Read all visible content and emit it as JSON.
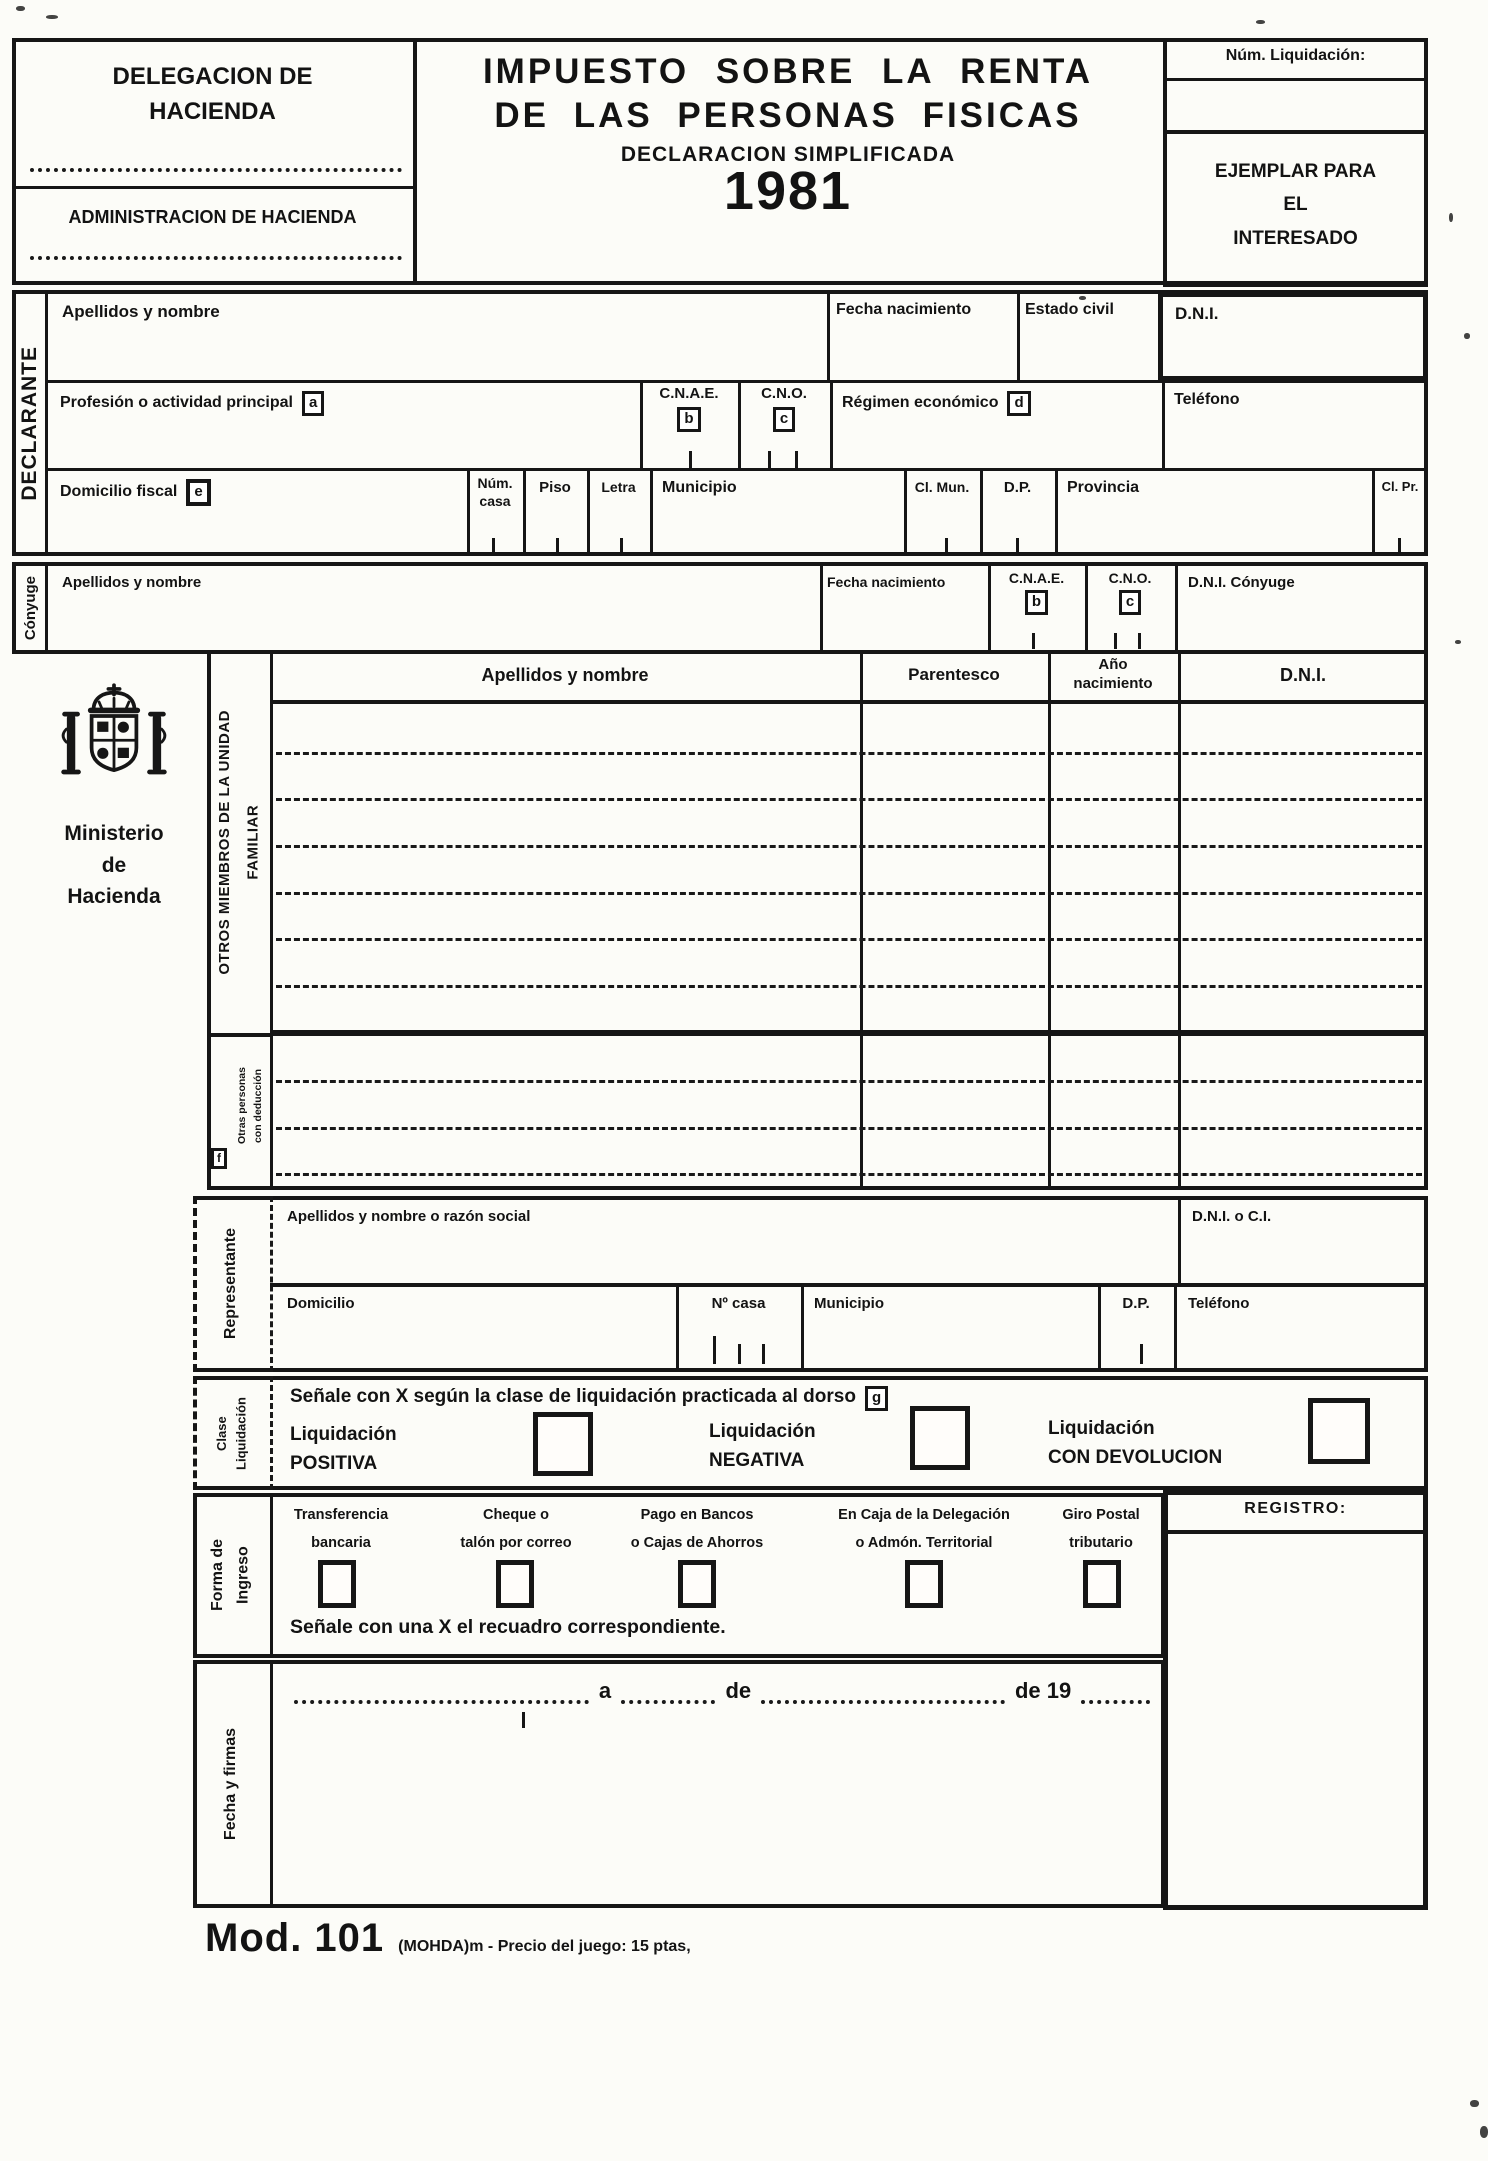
{
  "header": {
    "delegacion": "DELEGACION DE\nHACIENDA",
    "administracion": "ADMINISTRACION DE HACIENDA",
    "title1": "IMPUESTO SOBRE LA RENTA",
    "title2": "DE LAS PERSONAS FISICAS",
    "subtitle": "DECLARACION SIMPLIFICADA",
    "year": "1981",
    "num_liquidacion": "Núm. Liquidación:",
    "ejemplar": "EJEMPLAR PARA\nEL\nINTERESADO"
  },
  "tags": {
    "a": "a",
    "b": "b",
    "c": "c",
    "d": "d",
    "e": "e",
    "f": "f",
    "g": "g"
  },
  "declarante": {
    "label": "DECLARANTE",
    "apellidos": "Apellidos y nombre",
    "fecha_nac": "Fecha nacimiento",
    "estado_civil": "Estado civil",
    "dni": "D.N.I.",
    "profesion": "Profesión o actividad principal",
    "cnae": "C.N.A.E.",
    "cno": "C.N.O.",
    "regimen": "Régimen económico",
    "telefono": "Teléfono",
    "domicilio": "Domicilio fiscal",
    "num_casa": "Núm.\ncasa",
    "piso": "Piso",
    "letra": "Letra",
    "municipio": "Municipio",
    "cl_mun": "Cl. Mun.",
    "dp": "D.P.",
    "provincia": "Provincia",
    "cl_pr": "Cl. Pr."
  },
  "conyuge": {
    "label": "Cónyuge",
    "apellidos": "Apellidos y nombre",
    "fecha_nac": "Fecha nacimiento",
    "cnae": "C.N.A.E.",
    "cno": "C.N.O.",
    "dni": "D.N.I. Cónyuge"
  },
  "ministerio": {
    "nombre": "Ministerio\nde\nHacienda"
  },
  "familia": {
    "seccion": "OTROS MIEMBROS DE LA UNIDAD\nFAMILIAR",
    "otras": "Otras personas\ncon deducción",
    "col_nombre": "Apellidos y nombre",
    "col_parentesco": "Parentesco",
    "col_ano": "Año\nnacimiento",
    "col_dni": "D.N.I."
  },
  "representante": {
    "label": "Representante",
    "razon": "Apellidos y nombre o razón social",
    "dni_ci": "D.N.I. o C.I.",
    "domicilio": "Domicilio",
    "num_casa": "Nº casa",
    "municipio": "Municipio",
    "dp": "D.P.",
    "telefono": "Teléfono"
  },
  "clase": {
    "label": "Clase\nLiquidación",
    "instruccion": "Señale con X según la clase de liquidación practicada al dorso",
    "op1": "Liquidación\nPOSITIVA",
    "op2": "Liquidación\nNEGATIVA",
    "op3": "Liquidación\nCON DEVOLUCION"
  },
  "forma": {
    "label": "Forma de\nIngreso",
    "op1": "Transferencia\nbancaria",
    "op2": "Cheque o\ntalón por correo",
    "op3": "Pago en Bancos\no Cajas de Ahorros",
    "op4": "En Caja de la Delegación\no Admón. Territorial",
    "op5": "Giro Postal\ntributario",
    "instruccion": "Señale con una X el recuadro correspondiente."
  },
  "registro": {
    "label": "REGISTRO:"
  },
  "fecha": {
    "label": "Fecha y firmas",
    "a": "a",
    "de": "de",
    "de19": "de 19"
  },
  "footer": {
    "mod": "Mod. 101",
    "info": "(MOHDA)m - Precio del juego: 15 ptas,"
  }
}
